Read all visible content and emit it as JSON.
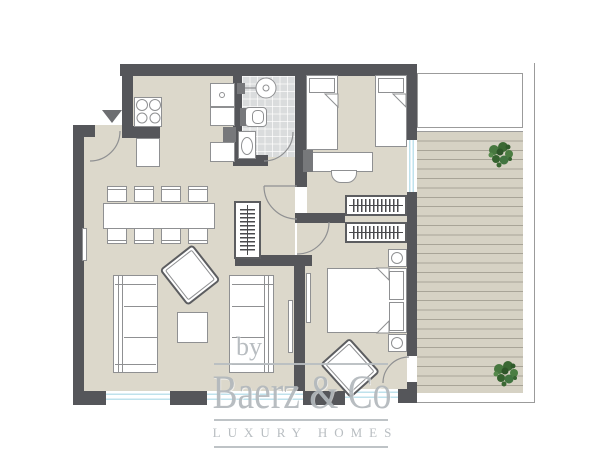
{
  "watermark": {
    "prefix": "by",
    "brand": "Baerz & Co",
    "tagline": "LUXURY HOMES"
  },
  "colors": {
    "canvas": "#ffffff",
    "wall": "#55565a",
    "floor": "#dcd8cb",
    "tile": "#dadcdd",
    "deck": "#d6d2c4",
    "deck_line": "#a8a497",
    "glass": "#bfe2ec",
    "outline": "#8f9092",
    "plant": "#3e6b39",
    "watermark": "#b2b8bc"
  },
  "symbols": [
    "entrance-arrow",
    "entrance-door",
    "stove-burners",
    "kitchen-cabinet",
    "fridge",
    "shower-head",
    "toilet",
    "washbasin",
    "bathroom-tiles",
    "dining-table",
    "dining-chair",
    "wardrobe-hanging-rail",
    "single-bed",
    "pillow",
    "duvet-fold",
    "desk",
    "desk-chair",
    "dresser",
    "double-bed",
    "nightstand",
    "bedside-lamp",
    "sofa",
    "coffee-table",
    "armchair",
    "radiator",
    "door-swing-arc",
    "window-glazing",
    "terrace-decking",
    "garden-plant",
    "plot-boundary-line"
  ]
}
